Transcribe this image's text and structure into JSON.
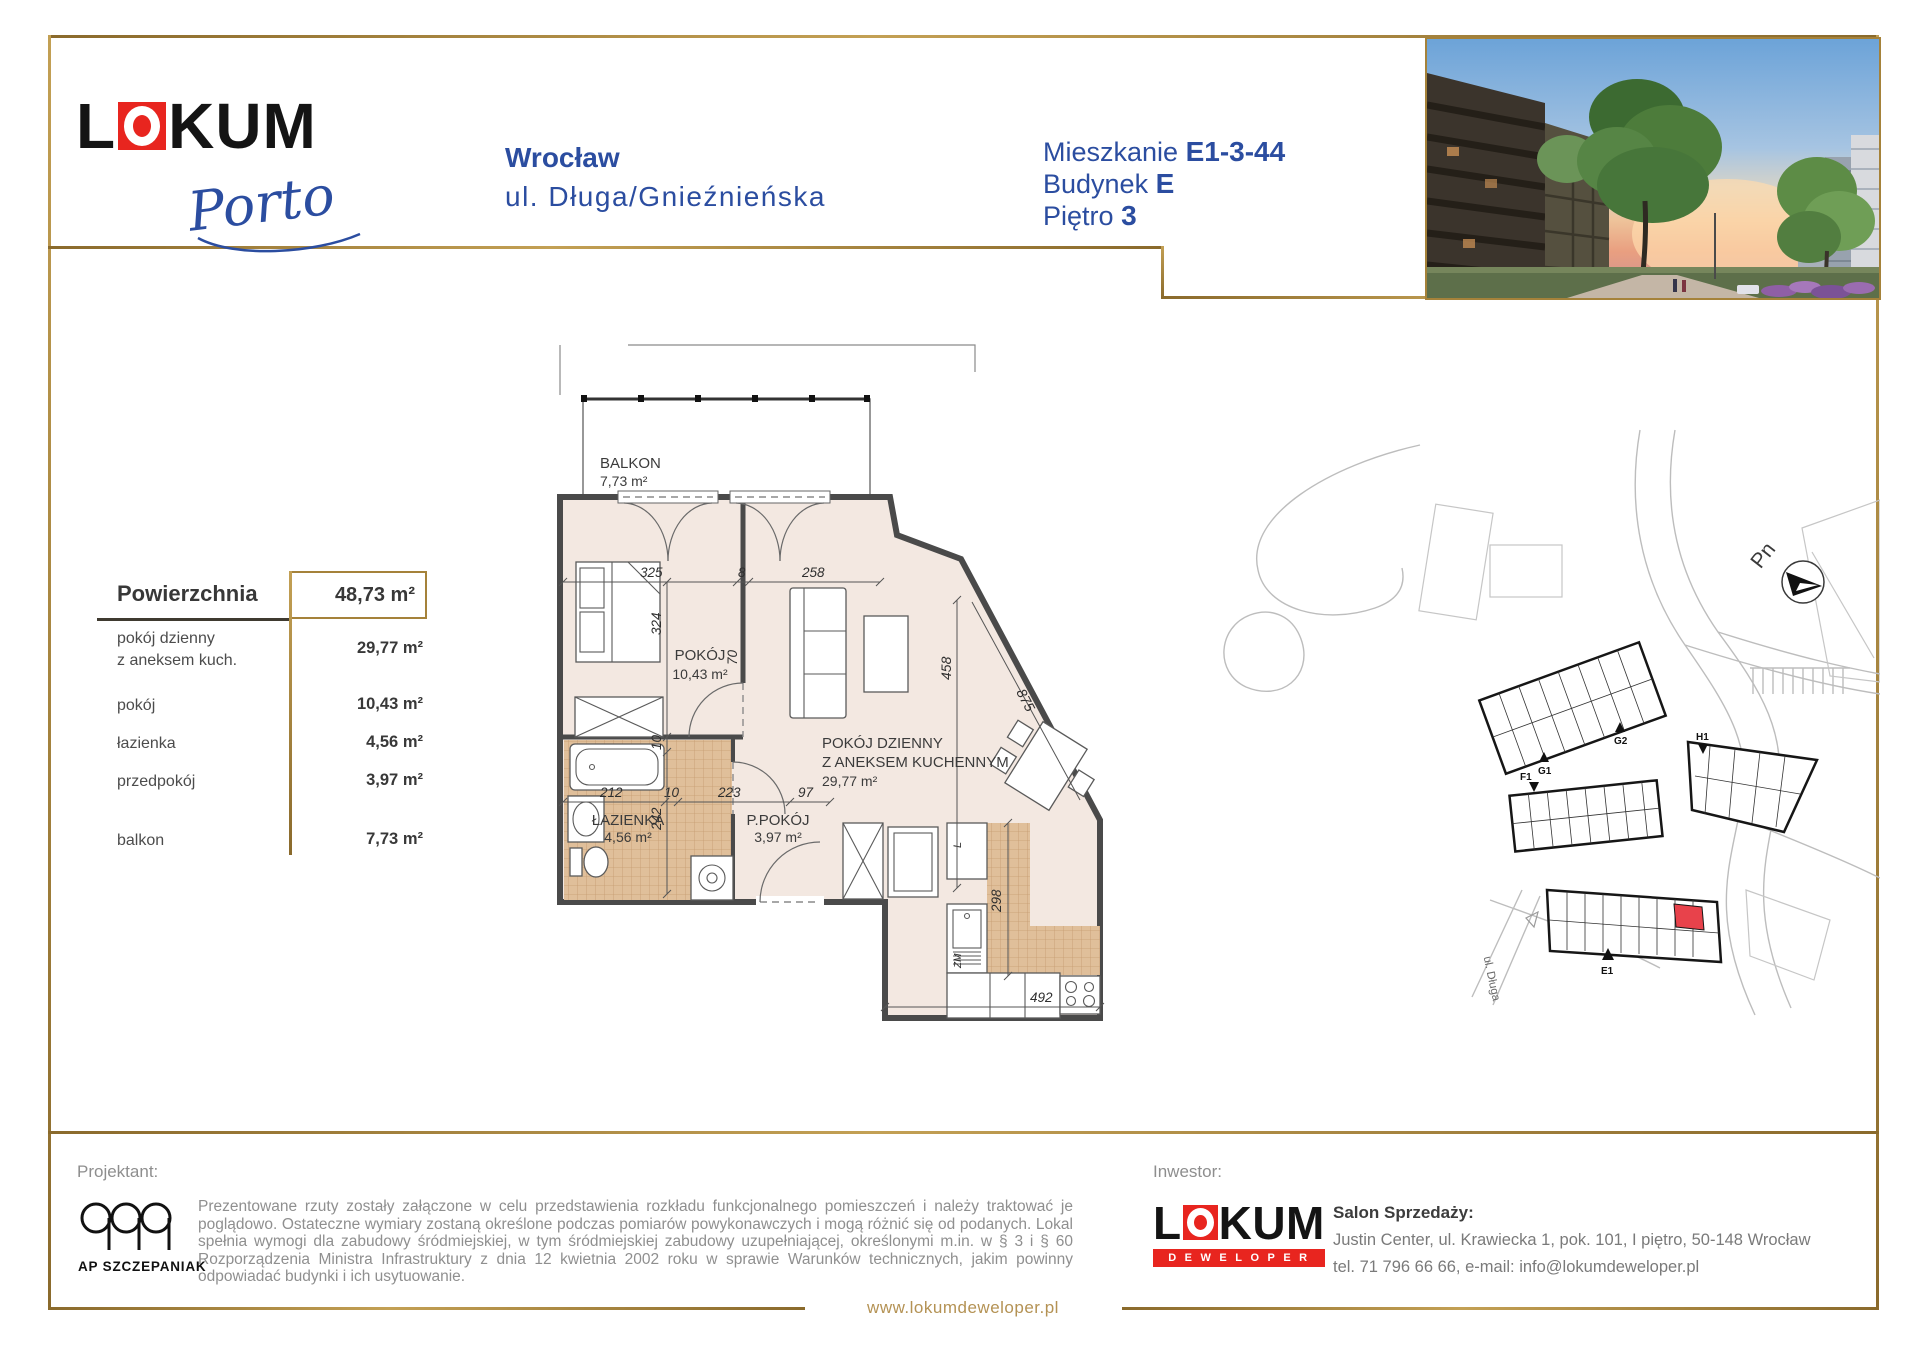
{
  "colors": {
    "gold": "#a5823a",
    "blue": "#2b4da0",
    "brand_red": "#e8251f",
    "unit_red": "#e8424b",
    "plan_fill": "#f3e8e1",
    "tile_fill": "#e0bf9a"
  },
  "brand": {
    "word_l": "L",
    "word_rest": "KUM",
    "script": "Porto"
  },
  "header": {
    "city": "Wrocław",
    "address": "ul. Długa/Gnieźnieńska",
    "apt_label": "Mieszkanie",
    "apt_value": "E1-3-44",
    "bld_label": "Budynek",
    "bld_value": "E",
    "floor_label": "Piętro",
    "floor_value": "3"
  },
  "area_table": {
    "header_label": "Powierzchnia",
    "header_value": "48,73 m²",
    "rows": [
      {
        "label": "pokój dzienny",
        "label2": "z aneksem kuch.",
        "value": "29,77 m²"
      },
      {
        "label": "pokój",
        "value": "10,43 m²"
      },
      {
        "label": "łazienka",
        "value": "4,56 m²"
      },
      {
        "label": "przedpokój",
        "value": "3,97 m²"
      },
      {
        "label": "balkon",
        "value": "7,73 m²"
      }
    ]
  },
  "plan": {
    "rooms": {
      "balkon": "BALKON",
      "balkon_area": "7,73 m²",
      "pokoj": "POKÓJ",
      "pokoj_area": "10,43 m²",
      "living1": "POKÓJ DZIENNY",
      "living2": "Z ANEKSEM KUCHENNYM",
      "living_area": "29,77 m²",
      "lazienka": "ŁAZIENKA",
      "lazienka_area": "4,56 m²",
      "ppokoj": "P.POKÓJ",
      "ppokoj_area": "3,97 m²"
    },
    "dims": {
      "d325": "325",
      "d8": "8",
      "d258": "258",
      "d212": "212",
      "d10a": "10",
      "d223": "223",
      "d97": "97",
      "d324": "324",
      "d10b": "10",
      "d242": "242",
      "d70": "70",
      "d458": "458",
      "d875": "875",
      "d298": "298",
      "d492": "492"
    },
    "fixtures": {
      "sink_label": "ZM",
      "cab_label": "L"
    }
  },
  "siteplan": {
    "compass": "Pn",
    "street": "ul. Długa",
    "b_g1": "G1",
    "b_g2": "G2",
    "b_f1": "F1",
    "b_h1": "H1",
    "b_e1": "E1"
  },
  "footer": {
    "designer_label": "Projektant:",
    "designer_name": "AP SZCZEPANIAK",
    "disclaimer": "Prezentowane rzuty zostały załączone w celu przedstawienia rozkładu funkcjonalnego pomieszczeń i należy traktować je poglądowo. Ostateczne wymiary zostaną określone podczas pomiarów powykonawczych i mogą różnić się od podanych. Lokal spełnia wymogi dla zabudowy śródmiejskiej, w tym śródmiejskiej zabudowy uzupełniającej, określonymi m.in. w § 3 i § 60 Rozporządzenia Ministra Infrastruktury z dnia 12 kwietnia 2002 roku w sprawie Warunków technicznych, jakim powinny odpowiadać budynki i ich usytuowanie.",
    "investor_label": "Inwestor:",
    "investor_word_l": "L",
    "investor_word_rest": "KUM",
    "investor_sub": "DEWELOPER",
    "sales_title": "Salon Sprzedaży:",
    "sales_line1": "Justin Center, ul. Krawiecka 1, pok. 101, I piętro, 50-148 Wrocław",
    "sales_line2": "tel. 71 796 66 66, e-mail: info@lokumdeweloper.pl",
    "website": "www.lokumdeweloper.pl"
  }
}
